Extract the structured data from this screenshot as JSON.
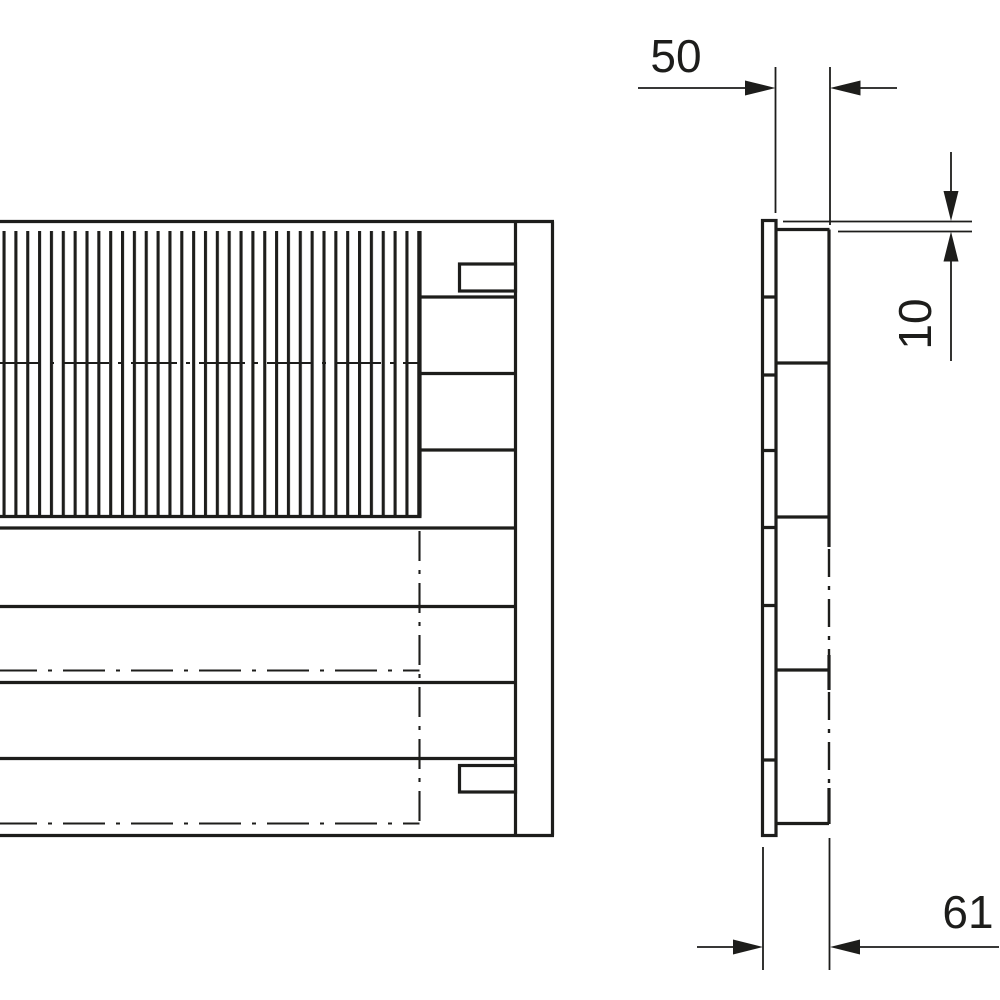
{
  "drawing": {
    "type": "technical-dimension-drawing",
    "background_color": "#ffffff",
    "line_color": "#1d1d1b",
    "views": {
      "front_view": "front-projection-with-vertical-fin-hatching",
      "side_view": "side-profile-with-flange-strip"
    },
    "dimensions": [
      {
        "id": "body-depth",
        "label": "50",
        "orientation": "horizontal"
      },
      {
        "id": "flange-offset",
        "label": "10",
        "orientation": "vertical"
      },
      {
        "id": "total-depth",
        "label": "61",
        "orientation": "horizontal"
      }
    ]
  }
}
